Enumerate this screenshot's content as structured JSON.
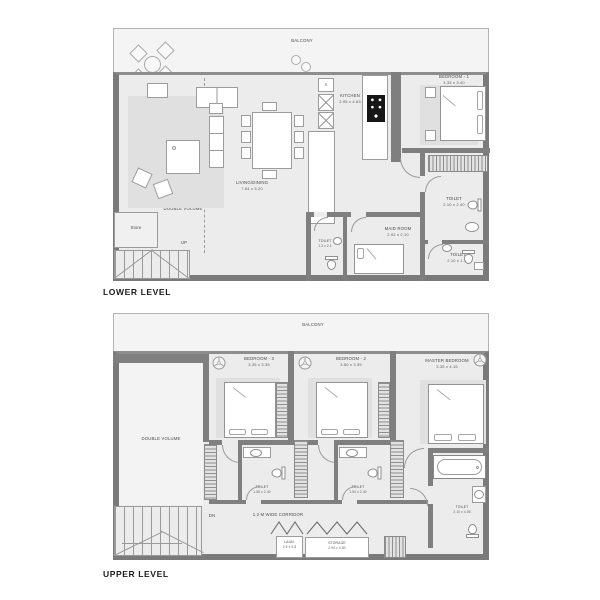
{
  "colors": {
    "wall": "#7a7a7a",
    "wall_medium": "#8d8d8d",
    "floor": "#ececec",
    "balcony_floor": "#f4f4f4",
    "line": "#9a9a9a",
    "rug": "#e0e0e0",
    "label_text": "#4a4a4a",
    "title_text": "#1c1c1c"
  },
  "lower": {
    "title": "LOWER LEVEL",
    "balcony_label": "BALCONY",
    "living": {
      "name": "LIVING/DINING",
      "dims": "7.64 x 5.20"
    },
    "kitchen": {
      "name": "KITCHEN",
      "dims": "2.95 x 4.63",
      "sink": "S"
    },
    "bedroom1": {
      "name": "BEDROOM - 1",
      "dims": "3.35 x 3.40"
    },
    "toilet_ensuite": {
      "name": "TOILET",
      "dims": "2.10 x 2.40"
    },
    "toilet_powder": {
      "name": "TOILET",
      "dims": "1.3 x 2.1"
    },
    "maid": {
      "name": "MAID ROOM",
      "dims": "2.92 x 2.10"
    },
    "toilet_guest": {
      "name": "TOILET",
      "dims": "2.10 x 1.30"
    },
    "double_volume": "DOUBLE VOLUME",
    "store": "Store",
    "up": "UP"
  },
  "upper": {
    "title": "UPPER LEVEL",
    "balcony_label": "BALCONY",
    "bedroom3": {
      "name": "BEDROOM - 3",
      "dims": "3.35 x 3.35"
    },
    "bedroom2": {
      "name": "BEDROOM - 2",
      "dims": "3.50 x 3.35"
    },
    "master": {
      "name": "MASTER BEDROOM",
      "dims": "3.35 x 4.15"
    },
    "toilet3": {
      "name": "TOILET",
      "dims": "1.55 x 2.40"
    },
    "toilet2": {
      "name": "TOILET",
      "dims": "1.54 x 2.40"
    },
    "master_toilet": {
      "name": "TOILET",
      "dims": "2.10 x 4.05"
    },
    "double_volume": "DOUBLE VOLUME",
    "corridor": "1.2 M WIDE CORRIDOR",
    "laundry": {
      "name": "LAUN.",
      "dims": "0.9 x 0.8"
    },
    "storage": {
      "name": "STORAGE",
      "dims": "2.94 x 0.80"
    },
    "dn": "DN"
  }
}
